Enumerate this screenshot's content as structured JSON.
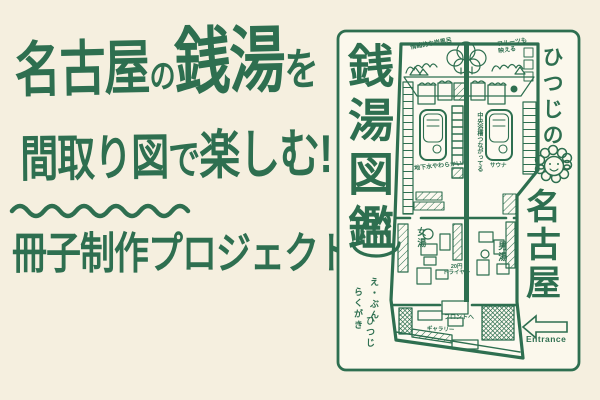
{
  "palette": {
    "ink": "#2e6f50",
    "background": "#f5efdf",
    "panel_background": "#fbf8ec"
  },
  "headline": {
    "line1_parts": [
      "名古屋",
      "の",
      "銭湯",
      "を"
    ],
    "line2_parts": [
      "間取り図",
      "で",
      "楽しむ!"
    ],
    "line3": "冊子制作プロジェクト"
  },
  "panel": {
    "booklet_title_vertical": "銭湯図鑑",
    "series_prefix_vertical": "ひつじの",
    "city_vertical": "名古屋",
    "onsen_mark": "♨",
    "credits": [
      "え・ぶん",
      "らくがき",
      "ひつじ"
    ],
    "entrance_label": "Entrance"
  },
  "floorplan_labels": {
    "mural_left": "情緒的な岩風呂",
    "mural_right": "フルーツも映える",
    "center_bath": "中央浴槽つながってる",
    "groundwater": "地下水やわらかい〜",
    "sauna": "サウナ",
    "womens_bath": "女湯",
    "mens_bath": "男湯",
    "dryer_line1": "20円",
    "dryer_line2": "ドライヤー",
    "front_desk": "フロントへ",
    "gallery": "ギャラリー"
  },
  "icons": {
    "sheep": "sheep-face",
    "onsen": "hot-spring-steam",
    "entrance_arrow": "left-arrow"
  }
}
